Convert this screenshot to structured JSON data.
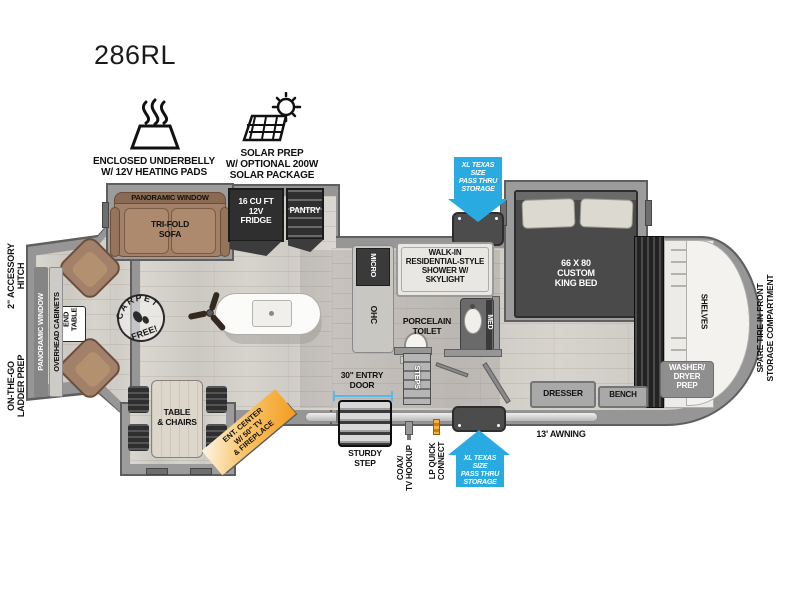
{
  "title": "286RL",
  "colors": {
    "arrow_blue": "#29abe2",
    "accent_orange": "#f7941e",
    "sofa_brown": "#a3806a",
    "wall_gray": "#969696",
    "appliance_dark": "#2f2f2f",
    "dimension_blue": "#5bb7e8"
  },
  "features": {
    "underbelly": {
      "icon": "heating-pads-icon",
      "label": "ENCLOSED UNDERBELLY\nW/ 12V HEATING PADS"
    },
    "solar": {
      "icon": "solar-prep-icon",
      "label": "SOLAR PREP\nW/ OPTIONAL 200W\nSOLAR PACKAGE"
    }
  },
  "exterior": {
    "hitch_label": "2\" ACCESSORY\nHITCH",
    "ladder_label": "ON-THE-GO\nLADDER PREP",
    "spare_tire": "SPARE TIRE IN FRONT\nSTORAGE COMPARTMENT",
    "pass_thru_top": "XL TEXAS SIZE\nPASS THRU\nSTORAGE",
    "pass_thru_bottom": "XL TEXAS SIZE\nPASS THRU\nSTORAGE",
    "awning": "13' AWNING",
    "entry_door": "30\" ENTRY\nDOOR",
    "sturdy_step": "STURDY\nSTEP",
    "coax": "COAX/\nTV HOOKUP",
    "lp": "LP QUICK\nCONNECT"
  },
  "living": {
    "rear_window": "PANORAMIC WINDOW",
    "overhead_cabinets": "OVERHEAD CABINETS",
    "end_table": "END\nTABLE",
    "stamp_top": "CARPET",
    "stamp_bottom": "FREE!",
    "sofa_window": "PANORAMIC WINDOW",
    "sofa": "TRI-FOLD\nSOFA",
    "dinette": "TABLE\n& CHAIRS",
    "ent_center": "ENT. CENTER\nW/ 50\" TV\n& FIREPLACE"
  },
  "kitchen": {
    "fridge": "16 CU FT\n12V\nFRIDGE",
    "pantry": "PANTRY",
    "micro": "MICRO",
    "ohc": "OHC"
  },
  "bath": {
    "shower": "WALK-IN\nRESIDENTIAL-STYLE\nSHOWER W/\nSKYLIGHT",
    "toilet": "PORCELAIN\nTOILET",
    "med": "MED",
    "steps": "STEPS"
  },
  "bedroom": {
    "bed": "66 X 80\nCUSTOM\nKING BED",
    "dresser": "DRESSER",
    "bench": "BENCH",
    "shelves": "SHELVES",
    "washer_dryer": "WASHER/\nDRYER\nPREP"
  }
}
